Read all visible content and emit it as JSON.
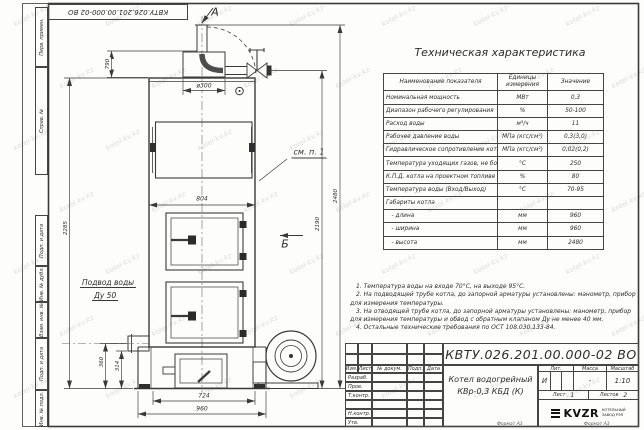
{
  "page": {
    "designation_rotated": "КВТУ.026.201.00.000-02  ВО",
    "format_labels": [
      "Формат А3",
      "Формат А3"
    ],
    "watermark": "kotel-kv.kz"
  },
  "frame_columns": {
    "perv_primen": "Перв. примен.",
    "sprav_no": "Справ. №",
    "podp_data_1": "Подп. и дата",
    "inv_dubl": "Инв. № дубл.",
    "vzam_inv": "Взам. инв. №",
    "podp_data_2": "Подп. и дата",
    "inv_podl": "Инв. № подл."
  },
  "drawing": {
    "section_a": "А",
    "section_b": "Б",
    "callout_see_item": "см. п. 1",
    "water_supply_line1": "Подвод воды",
    "water_supply_line2": "Ду 50",
    "dims": {
      "d790": "790",
      "d2285": "2285",
      "d2190": "2190",
      "d2480": "2480",
      "d804": "804",
      "d300": "ø300",
      "d360": "360",
      "d314": "314",
      "d724": "724",
      "d960": "960"
    }
  },
  "spec_table": {
    "title": "Техническая характеристика",
    "headers": [
      "Наименование показателя",
      "Единицы измерения",
      "Значение"
    ],
    "rows": [
      [
        "Номинальная мощность",
        "МВт",
        "0,3"
      ],
      [
        "Диапазон рабочего регулирования",
        "%",
        "50-100"
      ],
      [
        "Расход воды",
        "м³/ч",
        "11"
      ],
      [
        "Рабочее давление воды",
        "МПа (кгс/см²)",
        "0,3(3,0)"
      ],
      [
        "Гидравлическое сопротивление котла",
        "МПа (кгс/см²)",
        "0,02(0,2)"
      ],
      [
        "Температура уходящих газов, не более",
        "°С",
        "250"
      ],
      [
        "К.П.Д. котла на проектном топливе",
        "%",
        "80"
      ],
      [
        "Температура воды (Вход/Выход)",
        "°С",
        "70-95"
      ],
      [
        "Габариты котла",
        "",
        ""
      ],
      [
        "   - длина",
        "мм",
        "960"
      ],
      [
        "   - ширина",
        "мм",
        "960"
      ],
      [
        "   - высота",
        "мм",
        "2480"
      ]
    ]
  },
  "notes": [
    "1.  Температура воды на входе 70°С, на выходе 95°С.",
    "2.  На подводящей трубе котла, до запорной арматуры установлены: манометр, прибор для измерения температуры.",
    "3.  На отводящей трубе котла, до запорной арматуры установлены: манометр, прибор для измерения температуры и обвод с обратным клапаном Ду не менее 40 мм.",
    "4.  Остальные технические требования по ОСТ 108.030.133-84."
  ],
  "title_block": {
    "designation": "КВТУ.026.201.00.000-02  ВО",
    "doc_name_line1": "Котел водогрейный",
    "doc_name_line2": "КВр-0,3 КБД (К)",
    "header_cols": [
      "Изм.",
      "Лист",
      "№ докум.",
      "Подп.",
      "Дата"
    ],
    "row_labels": [
      "Разраб.",
      "Пров.",
      "Т.контр.",
      "",
      "Н.контр.",
      "Утв."
    ],
    "lit_label": "Лит.",
    "lit_value": "И",
    "mass_label": "Масса",
    "mass_value": "-",
    "scale_label": "Масштаб",
    "scale_value": "1:10",
    "sheet_label": "Лист",
    "sheet_value": "1",
    "sheets_label": "Листов",
    "sheets_value": "2",
    "company_logo": "KVZR",
    "company_name_line1": "КОТЕЛЬНЫЙ",
    "company_name_line2": "ЗАВОД РЭП"
  }
}
